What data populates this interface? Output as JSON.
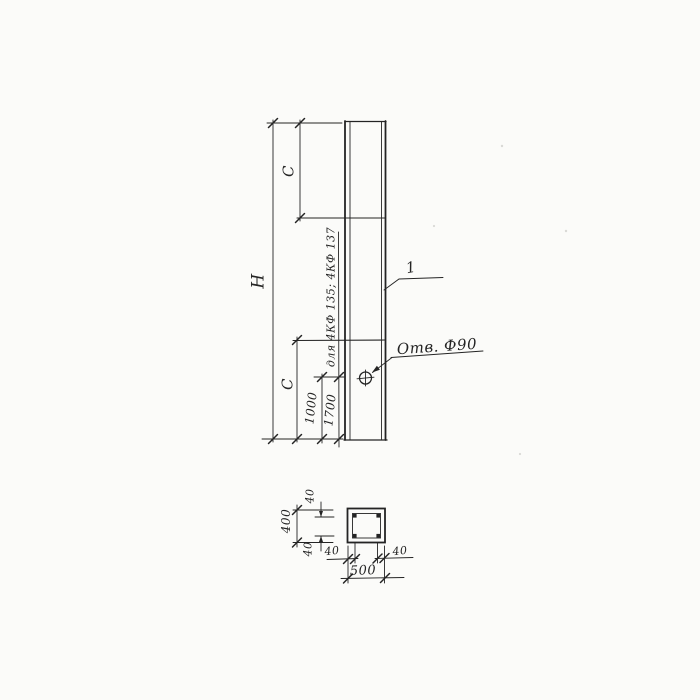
{
  "colors": {
    "background": "#fbfbf9",
    "ink": "#242424"
  },
  "elevation": {
    "height_label": "H",
    "segment_top_label": "C",
    "segment_bottom_label": "C",
    "hole_offset_main": "1000",
    "hole_offset_alt": "1700",
    "alt_note": "для 4КФ 135; 4КФ 137",
    "hole_callout": "Отв. Ф90",
    "position_mark": "1"
  },
  "section": {
    "overall_width": "500",
    "overall_height": "400",
    "cover_top": "40",
    "cover_bottom": "40",
    "cover_left": "40",
    "cover_right": "40"
  }
}
